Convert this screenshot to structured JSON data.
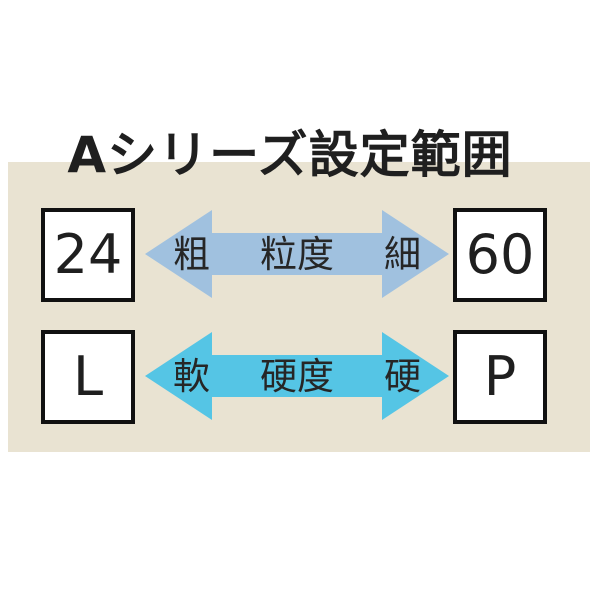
{
  "title": "Aシリーズ設定範囲",
  "colors": {
    "page_background": "#ffffff",
    "panel_background": "#e9e3d2",
    "grain_arrow": "#a0c1df",
    "hardness_arrow": "#55c5e5",
    "box_fill": "#ffffff",
    "box_border": "#111111",
    "text": "#262626"
  },
  "rows": [
    {
      "name": "grain-size",
      "left_value": "24",
      "right_value": "60",
      "left_label": "粗",
      "center_label": "粒度",
      "right_label": "細"
    },
    {
      "name": "hardness",
      "left_value": "L",
      "right_value": "P",
      "left_label": "軟",
      "center_label": "硬度",
      "right_label": "硬"
    }
  ]
}
